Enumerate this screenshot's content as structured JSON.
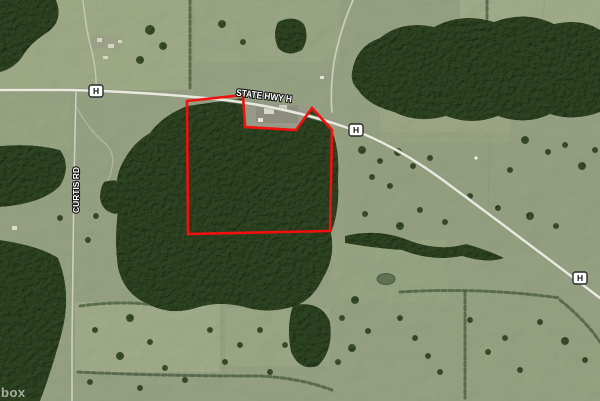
{
  "map": {
    "attribution": "box",
    "labels": {
      "highway": "STATE HWY H",
      "curtis": "CURTIS RD",
      "shield": "H",
      "highway_transform": "rotate(7 264 96)",
      "curtis_transform": "rotate(-90 76 190)"
    },
    "colors": {
      "boundary": "#f2100e",
      "field": "#96a383",
      "field_light": "#a3af8b",
      "forest": "#42553a",
      "road": "#e9e9dd",
      "road_casing": "#8d9383",
      "minor_road": "#d6d6c9",
      "shield_bg": "#fdfdfb",
      "shield_border": "#2a2a2a"
    },
    "geometry": {
      "parcel_points": "187,101 243,95 245,127 296,130 312,108 332,130 330,231 188,234",
      "hwy_h_path": "M0,90 L70,90 Q150,92 225,100 Q290,108 345,127 Q392,143 440,178 Q500,222 600,298",
      "curtis_rd_path": "M76,91 L74,180 Q73,260 72,340 L72,401",
      "nw_driveway_path": "M83,0 Q86,30 92,52 Q97,74 96,90",
      "farm_lane_path": "M77,108 Q88,128 101,140 Q112,148 113,160 Q112,172 108,180",
      "north_gravel_path": "M353,0 Q340,30 334,62 Q330,90 332,112"
    },
    "shields": [
      {
        "transform": "translate(96,91)"
      },
      {
        "transform": "translate(356,130)"
      },
      {
        "transform": "translate(580,278)"
      }
    ]
  }
}
